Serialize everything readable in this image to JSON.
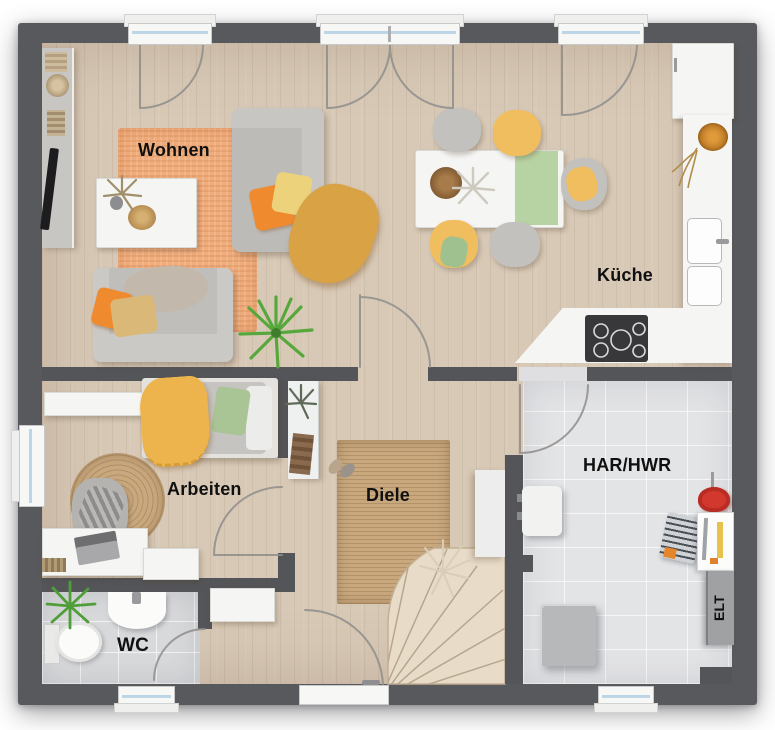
{
  "plan": {
    "kind": "floor-plan",
    "floor_description": "ground floor with open living/kitchen, hall with winder stairs, office, WC and utility room"
  },
  "rooms": {
    "living": {
      "label": "Wohnen"
    },
    "kitchen": {
      "label": "Küche"
    },
    "office": {
      "label": "Arbeiten"
    },
    "hallway": {
      "label": "Diele"
    },
    "wc": {
      "label": "WC"
    },
    "utility": {
      "label": "HAR/HWR"
    },
    "electrical": {
      "label": "ELT"
    }
  },
  "colors": {
    "exterior_wall": "#58595c",
    "interior_wall": "#545559",
    "wood_floor": "#d8c9b7",
    "wc_tile": "#d8d9db",
    "utility_tile": "#e3e4e6",
    "orange_rug": "#efac7d",
    "jute_rug": "#c9a87e",
    "stairs_wood": "#e8dcc9",
    "window_glass": "#bcd6e7",
    "accent_orange": "#f08a2e",
    "accent_mustard": "#d9a244",
    "chair_yellow": "#f0bd5f",
    "pillow_green": "#a9c596",
    "table_runner_green": "#b8d3a3",
    "cooktop_black": "#38383a",
    "tool_caddy_red": "#d2382e"
  }
}
